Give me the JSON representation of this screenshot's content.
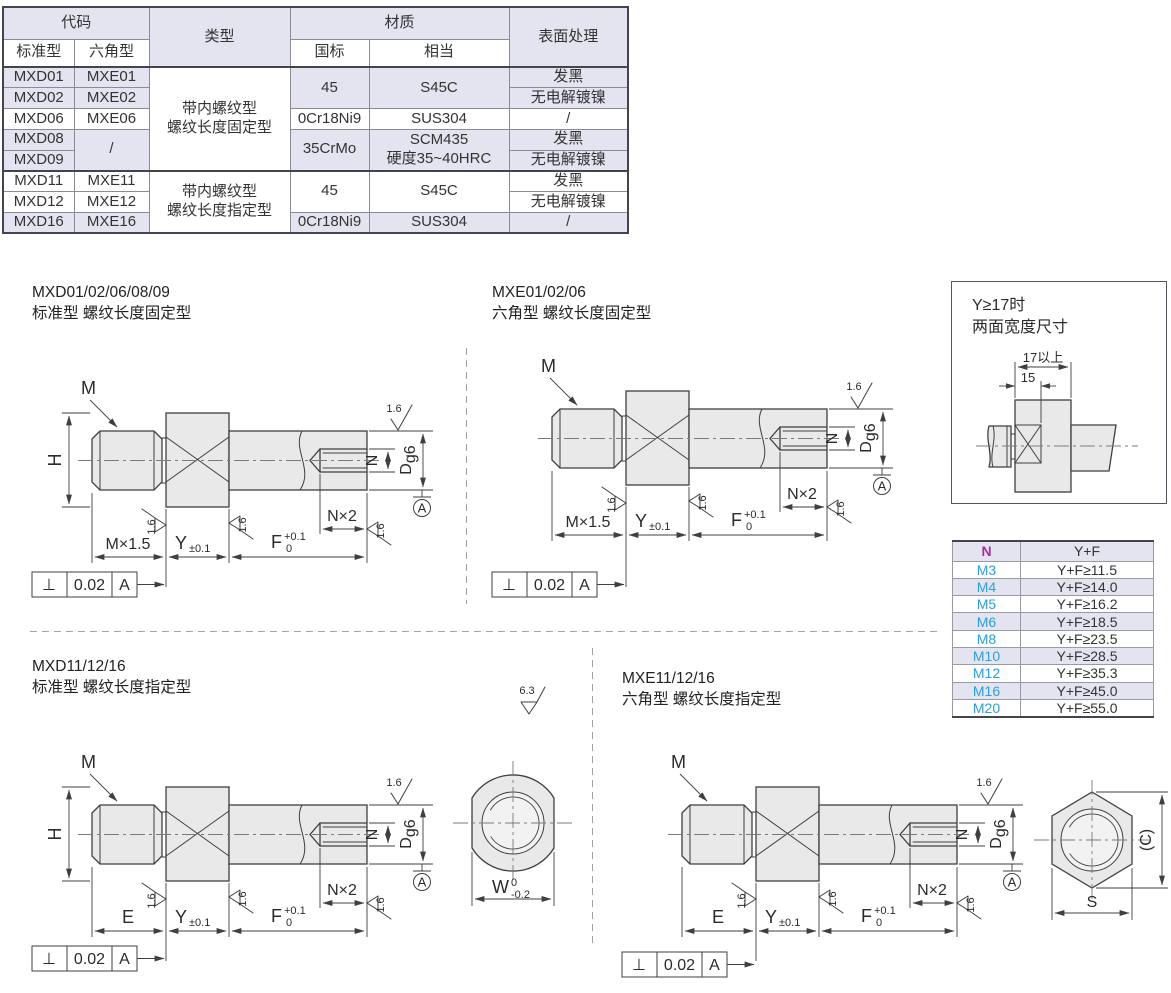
{
  "spec_table": {
    "headers": {
      "code": "代码",
      "std": "标准型",
      "hex": "六角型",
      "type": "类型",
      "material": "材质",
      "gb": "国标",
      "equiv": "相当",
      "surface": "表面处理"
    },
    "type_fixed": "带内螺纹型\n螺纹长度固定型",
    "type_specified": "带内螺纹型\n螺纹长度指定型",
    "row1": {
      "std": "MXD01",
      "hex": "MXE01",
      "gb": "45",
      "equiv": "S45C",
      "surface": "发黑"
    },
    "row2": {
      "std": "MXD02",
      "hex": "MXE02",
      "surface": "无电解镀镍"
    },
    "row3": {
      "std": "MXD06",
      "hex": "MXE06",
      "gb": "0Cr18Ni9",
      "equiv": "SUS304",
      "surface": "/"
    },
    "row4": {
      "std": "MXD08",
      "hex": "/",
      "gb": "35CrMo",
      "equiv": "SCM435\n硬度35~40HRC",
      "surface": "发黑"
    },
    "row5": {
      "std": "MXD09",
      "surface": "无电解镀镍"
    },
    "row6": {
      "std": "MXD11",
      "hex": "MXE11",
      "gb": "45",
      "equiv": "S45C",
      "surface": "发黑"
    },
    "row7": {
      "std": "MXD12",
      "hex": "MXE12",
      "surface": "无电解镀镍"
    },
    "row8": {
      "std": "MXD16",
      "hex": "MXE16",
      "gb": "0Cr18Ni9",
      "equiv": "SUS304",
      "surface": "/"
    }
  },
  "n_table": {
    "header_n": "N",
    "header_yf": "Y+F",
    "rows": [
      [
        "M3",
        "Y+F≥11.5"
      ],
      [
        "M4",
        "Y+F≥14.0"
      ],
      [
        "M5",
        "Y+F≥16.2"
      ],
      [
        "M6",
        "Y+F≥18.5"
      ],
      [
        "M8",
        "Y+F≥23.5"
      ],
      [
        "M10",
        "Y+F≥28.5"
      ],
      [
        "M12",
        "Y+F≥35.3"
      ],
      [
        "M16",
        "Y+F≥45.0"
      ],
      [
        "M20",
        "Y+F≥55.0"
      ]
    ]
  },
  "info_box": {
    "title_line1": "Y≥17时",
    "title_line2": "两面宽度尺寸",
    "dim_over17": "17以上",
    "dim_15": "15"
  },
  "drawings": {
    "d1": {
      "code": "MXD01/02/06/08/09",
      "subtitle": "标准型 螺纹长度固定型",
      "first_dim": "M×1.5"
    },
    "d2": {
      "code": "MXE01/02/06",
      "subtitle": "六角型 螺纹长度固定型",
      "first_dim": "M×1.5"
    },
    "d3": {
      "code": "MXD11/12/16",
      "subtitle": "标准型 螺纹长度指定型",
      "first_dim": "E"
    },
    "d4": {
      "code": "MXE11/12/16",
      "subtitle": "六角型 螺纹长度指定型",
      "first_dim": "E"
    },
    "labels": {
      "thread": "M",
      "height": "H",
      "y": "Y",
      "y_tol": "±0.1",
      "f": "F",
      "f_sup": "+0.1",
      "f_sub": "0",
      "n": "N",
      "n_depth": "N×2",
      "dia": "D",
      "dia_sub": "g6",
      "finish_fine": "1.6",
      "finish_coarse": "6.3",
      "datum": "A",
      "perp": "⊥",
      "tol": "0.02"
    },
    "front_round": {
      "w": "W",
      "w_sup": "0",
      "w_sub": "-0.2"
    },
    "front_hex": {
      "s": "S",
      "c": "(C)"
    }
  }
}
